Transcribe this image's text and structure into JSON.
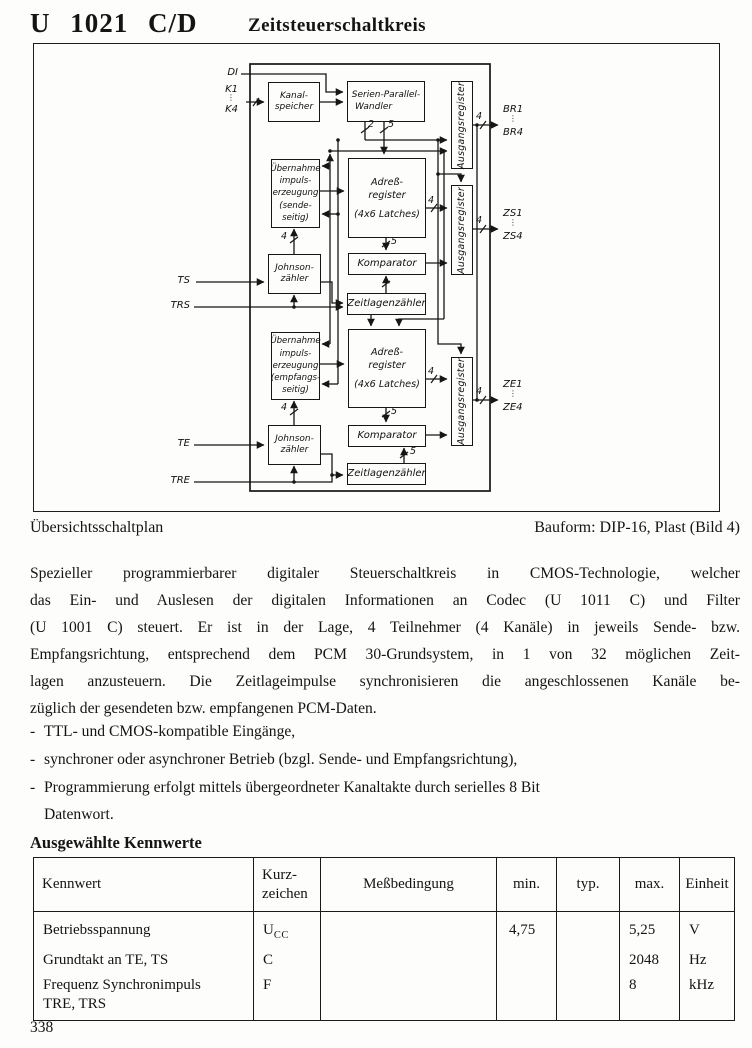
{
  "header": {
    "part_number": "U 1021 C/D",
    "subtitle": "Zeitsteuerschaltkreis"
  },
  "figure": {
    "caption_left": "Übersichtsschaltplan",
    "caption_right": "Bauform: DIP-16, Plast (Bild 4)",
    "blocks": {
      "kanalspeicher": {
        "l0": "Kanal-",
        "l1": "speicher"
      },
      "serien_parallel_wandler": {
        "l0": "Serien-Parallel-",
        "l1": "Wandler"
      },
      "ausgangsregister": "Ausgangsregister",
      "uebernahme_sende": {
        "l0": "Übernahme",
        "l1": "impuls-",
        "l2": "erzeugung",
        "l3": "(sende-",
        "l4": "seitig)"
      },
      "adressregister": {
        "l0": "Adreß-",
        "l1": "register",
        "l2": "(4x6 Latches)"
      },
      "johnson": {
        "l0": "Johnson-",
        "l1": "zähler"
      },
      "komparator": "Komparator",
      "zeitlagenzaehler": "Zeitlagenzähler",
      "uebernahme_empfang": {
        "l0": "Übernahme",
        "l1": "impuls-",
        "l2": "erzeugung",
        "l3": "(empfangs-",
        "l4": "seitig)"
      }
    },
    "pins": {
      "di": "DI",
      "k1": "K1",
      "k4": "K4",
      "ts": "TS",
      "trs": "TRS",
      "te": "TE",
      "tre": "TRE",
      "br1": "BR1",
      "br4": "BR4",
      "zs1": "ZS1",
      "zs4": "ZS4",
      "ze1": "ZE1",
      "ze4": "ZE4",
      "dots": "⋮"
    },
    "bus": {
      "two": "2",
      "five": "5",
      "four": "4"
    }
  },
  "paragraph": {
    "lines": [
      "Spezieller programmierbarer digitaler Steuerschaltkreis in CMOS-Technologie, welcher",
      "das Ein- und Auslesen der digitalen Informationen an Codec (U 1011 C) und Filter",
      "(U 1001 C) steuert. Er ist in der Lage, 4 Teilnehmer (4 Kanäle) in jeweils Sende- bzw.",
      "Empfangsrichtung, entsprechend dem PCM 30-Grundsystem, in 1 von 32 möglichen Zeit-",
      "lagen anzusteuern. Die Zeitlageimpulse synchronisieren die angeschlossenen Kanäle be-",
      "züglich der gesendeten bzw. empfangenen PCM-Daten."
    ]
  },
  "bullets": {
    "marker": "-",
    "b0": "TTL- und CMOS-kompatible Eingänge,",
    "b1": "synchroner oder asynchroner Betrieb (bzgl. Sende- und Empfangsrichtung),",
    "b2a": "Programmierung erfolgt mittels übergeordneter Kanaltakte durch serielles 8 Bit",
    "b2b": "Datenwort."
  },
  "table": {
    "title": "Ausgewählte Kennwerte",
    "headers": {
      "kennwert": "Kennwert",
      "kurz_l0": "Kurz-",
      "kurz_l1": "zeichen",
      "messbedingung": "Meßbedingung",
      "min": "min.",
      "typ": "typ.",
      "max": "max.",
      "einheit": "Einheit"
    },
    "rows": [
      {
        "kennwert": "Betriebsspannung",
        "kurz": "U",
        "kurz_sub": "CC",
        "messbedingung": "",
        "min": "4,75",
        "typ": "",
        "max": "5,25",
        "einheit": "V"
      },
      {
        "kennwert": "Grundtakt an TE, TS",
        "kurz": "C",
        "kurz_sub": "",
        "messbedingung": "",
        "min": "",
        "typ": "",
        "max": "2048",
        "einheit": "Hz"
      },
      {
        "kennwert": "Frequenz Synchronimpuls",
        "kennwert_l2": "TRE, TRS",
        "kurz": "F",
        "kurz_sub": "",
        "messbedingung": "",
        "min": "",
        "typ": "",
        "max": "8",
        "einheit": "kHz"
      }
    ]
  },
  "page_number": "338"
}
